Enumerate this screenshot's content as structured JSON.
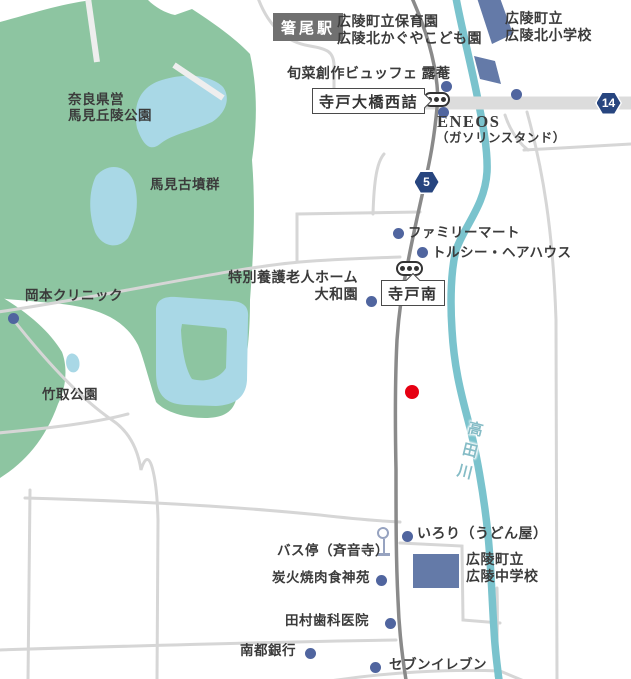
{
  "station": {
    "name": "箸尾駅"
  },
  "routes": {
    "r14": "14",
    "r5": "5"
  },
  "river": {
    "name": "高田川"
  },
  "intersections": {
    "terado_ohashi": "寺戸大橋西詰",
    "terado_minami": "寺戸南"
  },
  "areas": {
    "nara_line1": "奈良県営",
    "nara_line2": "馬見丘陵公園",
    "kofun": "馬見古墳群",
    "taketori": "竹取公園"
  },
  "pois": {
    "hoikuen_line1": "広陵町立保育園",
    "hoikuen_line2": "広陵北かぐやこども園",
    "kita_sho_line1": "広陵町立",
    "kita_sho_line2": "広陵北小学校",
    "buffet": "旬菜創作ビュッフェ 露菴",
    "eneos_line1": "ENEOS",
    "eneos_line2": "（ガソリンスタンド）",
    "famima": "ファミリーマート",
    "hairhouse": "トルシー・ヘアハウス",
    "yamatoen_line1": "特別養護老人ホーム",
    "yamatoen_line2": "大和園",
    "okamoto": "岡本クリニック",
    "irori": "いろり（うどん屋）",
    "busstop": "バス停（斉音寺）",
    "chugakko_line1": "広陵町立",
    "chugakko_line2": "広陵中学校",
    "yakiniku": "炭火焼肉食神苑",
    "tamura": "田村歯科医院",
    "nanto": "南都銀行",
    "seven": "セブンイレブン"
  },
  "colors": {
    "park": "#8dc5a1",
    "pond": "#a9d8e6",
    "river": "#7ac3cd",
    "building": "#647aa8",
    "poi_dot": "#50659f",
    "destination": "#e60012",
    "road_main": "#8a8a8a",
    "road_light": "#d6d6d6",
    "road_wide": "#dcdcdc",
    "badge": "#27457f"
  }
}
